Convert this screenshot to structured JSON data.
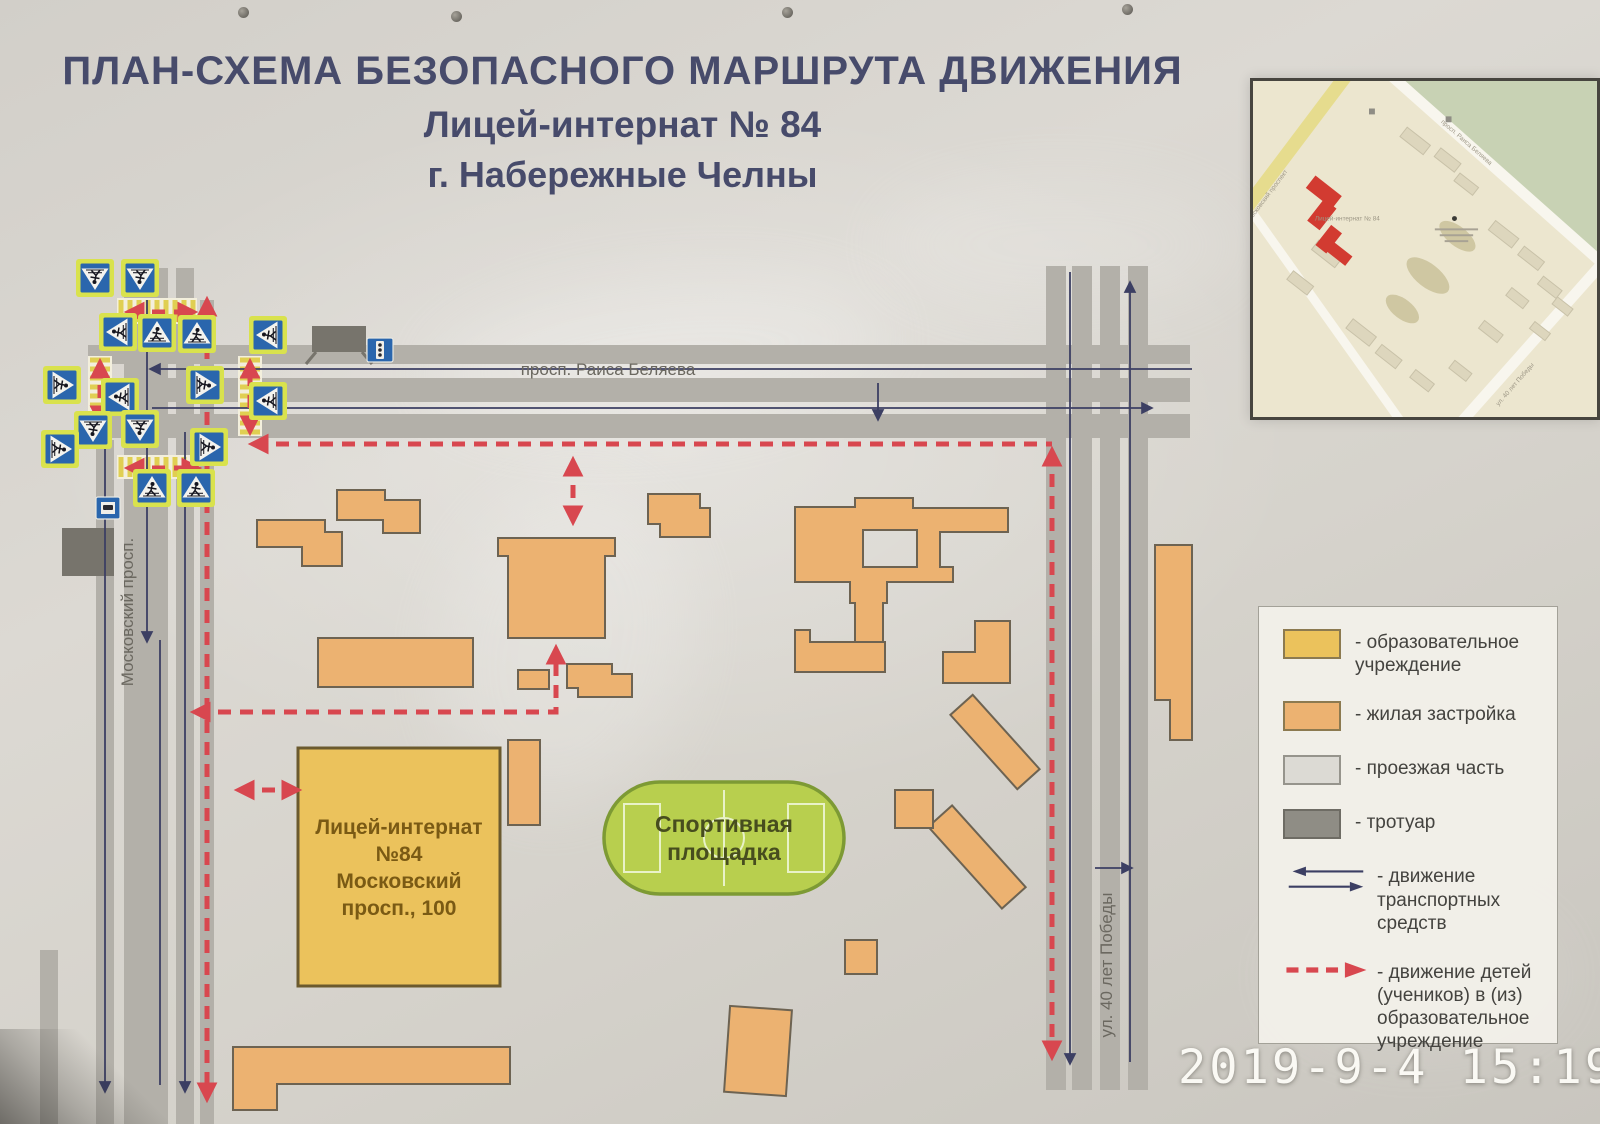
{
  "title": {
    "line1": "ПЛАН-СХЕМА БЕЗОПАСНОГО МАРШРУТА ДВИЖЕНИЯ",
    "line2": "Лицей-интернат № 84",
    "line3": "г. Набережные Челны"
  },
  "timestamp": "2019-9-4 15:19",
  "colors": {
    "title": "#474b6b",
    "road": "#b3b0a9",
    "sidewalk": "#77746c",
    "residential_fill": "#ecb271",
    "residential_stroke": "#6d6352",
    "school_fill": "#ebc25c",
    "school_stroke": "#6b5a2e",
    "school_text": "#7a5a14",
    "field_fill": "#b8cf4e",
    "field_stroke": "#7d9a34",
    "field_lines": "#e9f2c8",
    "field_text": "#474d1e",
    "route": "#d8474f",
    "traffic": "#3c3f63",
    "street_label": "#6b6860",
    "sign_blue": "#2a66ad",
    "sign_border": "#d9e24d",
    "zebra_base": "#f3efdc",
    "zebra_stripe": "#e0cf52"
  },
  "map": {
    "road_rects": [
      [
        88,
        345,
        1102,
        19
      ],
      [
        88,
        378,
        1102,
        24
      ],
      [
        88,
        414,
        1102,
        24
      ],
      [
        124,
        268,
        44,
        856
      ],
      [
        176,
        268,
        18,
        856
      ],
      [
        200,
        300,
        14,
        824
      ],
      [
        96,
        440,
        18,
        684
      ],
      [
        40,
        950,
        18,
        174
      ],
      [
        1046,
        266,
        20,
        824
      ],
      [
        1072,
        266,
        20,
        824
      ],
      [
        1100,
        266,
        20,
        824
      ],
      [
        1128,
        266,
        20,
        824
      ]
    ],
    "sidewalk_rects": [
      [
        312,
        326,
        54,
        26
      ],
      [
        62,
        528,
        52,
        48
      ]
    ],
    "zebras": [
      [
        117,
        298,
        80,
        26,
        "v"
      ],
      [
        88,
        356,
        24,
        72,
        "h"
      ],
      [
        238,
        356,
        24,
        80,
        "h"
      ],
      [
        117,
        455,
        80,
        24,
        "v"
      ]
    ],
    "buildings": [
      {
        "path": "M257,520 L325,520 L325,532 L342,532 L342,566 L302,566 L302,547 L257,547 Z"
      },
      {
        "path": "M337,490 L385,490 L385,500 L420,500 L420,533 L383,533 L383,520 L337,520 Z"
      },
      {
        "path": "M498,538 L615,538 L615,556 L605,556 L605,638 L508,638 L508,556 L498,556 Z"
      },
      {
        "rect": [
          518,
          670,
          31,
          19
        ]
      },
      {
        "rect": [
          318,
          638,
          155,
          49
        ]
      },
      {
        "path": "M567,664 L612,664 L612,674 L632,674 L632,697 L578,697 L578,688 L567,688 Z"
      },
      {
        "path": "M648,494 L700,494 L700,508 L710,508 L710,537 L660,537 L660,524 L648,524 Z"
      },
      {
        "path": "M795,507 L855,507 L855,498 L913,498 L913,508 L1008,508 L1008,532 L940,532 L940,567 L953,567 L953,582 L887,582 L887,603 L883,603 L883,642 L855,642 L855,603 L850,603 L850,582 L795,582 Z M863,530 L917,530 L917,567 L863,567 Z"
      },
      {
        "path": "M795,630 L810,630 L810,642 L885,642 L885,672 L795,672 Z"
      },
      {
        "path": "M975,621 L1010,621 L1010,683 L943,683 L943,652 L975,652 Z"
      },
      {
        "rect": [
          945,
          727,
          100,
          30
        ],
        "rot": 48
      },
      {
        "rect": [
          922,
          841,
          110,
          32
        ],
        "rot": 48
      },
      {
        "rect": [
          895,
          790,
          38,
          38
        ]
      },
      {
        "rect": [
          845,
          940,
          32,
          34
        ]
      },
      {
        "rect": [
          727,
          1008,
          62,
          86
        ],
        "rot": 4
      },
      {
        "path": "M233,1047 L510,1047 L510,1084 L277,1084 L277,1110 L233,1110 Z"
      },
      {
        "path": "M1155,545 L1192,545 L1192,740 L1170,740 L1170,700 L1155,700 Z"
      },
      {
        "rect": [
          508,
          740,
          32,
          85
        ]
      }
    ],
    "school": {
      "x": 298,
      "y": 748,
      "w": 202,
      "h": 238,
      "label_lines": [
        "Лицей-интернат",
        "№84",
        "Московский",
        "просп., 100"
      ]
    },
    "sports_field": {
      "x": 604,
      "y": 782,
      "w": 240,
      "h": 112,
      "label_lines": [
        "Спортивная",
        "площадка"
      ]
    },
    "street_labels": [
      {
        "text": "просп. Раиса Беляева",
        "x": 608,
        "y": 375,
        "rot": 0
      },
      {
        "text": "Московский просп.",
        "x": 133,
        "y": 612,
        "rot": -90
      },
      {
        "text": "ул. 40 лет Победы",
        "x": 1112,
        "y": 965,
        "rot": -90
      }
    ],
    "traffic_lines": [
      {
        "x1": 1192,
        "y1": 369,
        "x2": 152,
        "y2": 369,
        "arrow": "end"
      },
      {
        "x1": 152,
        "y1": 408,
        "x2": 1150,
        "y2": 408,
        "arrow": "end"
      },
      {
        "x1": 878,
        "y1": 383,
        "x2": 878,
        "y2": 418,
        "arrow": "end"
      },
      {
        "x1": 105,
        "y1": 432,
        "x2": 105,
        "y2": 1090,
        "arrow": "end"
      },
      {
        "x1": 147,
        "y1": 300,
        "x2": 147,
        "y2": 640,
        "arrow": "end"
      },
      {
        "x1": 185,
        "y1": 432,
        "x2": 185,
        "y2": 1090,
        "arrow": "end"
      },
      {
        "x1": 160,
        "y1": 640,
        "x2": 160,
        "y2": 1085,
        "arrow": "none"
      },
      {
        "x1": 1070,
        "y1": 272,
        "x2": 1070,
        "y2": 1062,
        "arrow": "end"
      },
      {
        "x1": 1130,
        "y1": 1062,
        "x2": 1130,
        "y2": 284,
        "arrow": "end"
      },
      {
        "x1": 1095,
        "y1": 868,
        "x2": 1130,
        "y2": 868,
        "arrow": "end"
      }
    ],
    "route_segments": [
      {
        "pts": [
          [
            207,
            302
          ],
          [
            207,
            1097
          ]
        ],
        "a_start": true,
        "a_end": true
      },
      {
        "pts": [
          [
            254,
            444
          ],
          [
            1052,
            444
          ]
        ],
        "a_start": true,
        "a_end": false
      },
      {
        "pts": [
          [
            1052,
            452
          ],
          [
            1052,
            1055
          ]
        ],
        "a_start": true,
        "a_end": true
      },
      {
        "pts": [
          [
            196,
            712
          ],
          [
            556,
            712
          ],
          [
            556,
            650
          ]
        ],
        "a_start": true,
        "a_end": true
      },
      {
        "pts": [
          [
            240,
            790
          ],
          [
            296,
            790
          ]
        ],
        "a_start": true,
        "a_end": true
      },
      {
        "pts": [
          [
            573,
            520
          ],
          [
            573,
            462
          ]
        ],
        "a_start": true,
        "a_end": true
      },
      {
        "pts": [
          [
            130,
            312
          ],
          [
            192,
            312
          ]
        ],
        "a_start": true,
        "a_end": true
      },
      {
        "pts": [
          [
            100,
            420
          ],
          [
            100,
            364
          ]
        ],
        "a_start": true,
        "a_end": true
      },
      {
        "pts": [
          [
            250,
            430
          ],
          [
            250,
            364
          ]
        ],
        "a_start": true,
        "a_end": true
      },
      {
        "pts": [
          [
            130,
            468
          ],
          [
            196,
            468
          ]
        ],
        "a_start": true,
        "a_end": true
      }
    ],
    "crossing_signs": [
      {
        "x": 95,
        "y": 278,
        "dir": "down"
      },
      {
        "x": 140,
        "y": 278,
        "dir": "down"
      },
      {
        "x": 118,
        "y": 332,
        "dir": "left"
      },
      {
        "x": 157,
        "y": 333,
        "dir": "up"
      },
      {
        "x": 197,
        "y": 334,
        "dir": "up"
      },
      {
        "x": 268,
        "y": 335,
        "dir": "left"
      },
      {
        "x": 62,
        "y": 385,
        "dir": "right"
      },
      {
        "x": 120,
        "y": 397,
        "dir": "left"
      },
      {
        "x": 205,
        "y": 385,
        "dir": "right"
      },
      {
        "x": 268,
        "y": 401,
        "dir": "left"
      },
      {
        "x": 93,
        "y": 430,
        "dir": "down"
      },
      {
        "x": 140,
        "y": 429,
        "dir": "down"
      },
      {
        "x": 60,
        "y": 449,
        "dir": "right"
      },
      {
        "x": 209,
        "y": 447,
        "dir": "right"
      },
      {
        "x": 152,
        "y": 488,
        "dir": "up"
      },
      {
        "x": 196,
        "y": 488,
        "dir": "up"
      }
    ],
    "bus_stop_sign": {
      "x": 108,
      "y": 508
    },
    "traffic_light_sign": {
      "x": 380,
      "y": 350
    }
  },
  "inset": {
    "green_poly": "155,0 350,0 350,178",
    "roads": [
      {
        "x1": 140,
        "y1": -6,
        "x2": 356,
        "y2": 186,
        "w": 11,
        "c": "#f8f6ee"
      },
      {
        "x1": 95,
        "y1": -6,
        "x2": -12,
        "y2": 136,
        "w": 14,
        "c": "#e6dc8e"
      },
      {
        "x1": 0,
        "y1": 135,
        "x2": 150,
        "y2": 346,
        "w": 9,
        "c": "#f8f6ee"
      },
      {
        "x1": 356,
        "y1": 185,
        "x2": 213,
        "y2": 346,
        "w": 11,
        "c": "#f8f6ee"
      }
    ],
    "buildings": [
      [
        150,
        55,
        30,
        12
      ],
      [
        185,
        75,
        26,
        11
      ],
      [
        205,
        100,
        24,
        10
      ],
      [
        240,
        150,
        30,
        12
      ],
      [
        270,
        175,
        26,
        11
      ],
      [
        290,
        205,
        24,
        10
      ],
      [
        258,
        216,
        22,
        10
      ],
      [
        60,
        170,
        30,
        12
      ],
      [
        35,
        200,
        26,
        11
      ],
      [
        95,
        250,
        30,
        12
      ],
      [
        125,
        275,
        26,
        11
      ],
      [
        160,
        300,
        24,
        10
      ],
      [
        200,
        290,
        22,
        10
      ],
      [
        230,
        250,
        24,
        10
      ],
      [
        282,
        250,
        20,
        9
      ],
      [
        305,
        225,
        20,
        9
      ]
    ],
    "yards": [
      [
        178,
        198,
        26,
        12
      ],
      [
        208,
        158,
        22,
        10
      ],
      [
        152,
        232,
        20,
        10
      ]
    ],
    "school_rects": [
      [
        55,
        105,
        34,
        16
      ],
      [
        62,
        122,
        16,
        28
      ],
      [
        70,
        148,
        14,
        26
      ],
      [
        76,
        170,
        24,
        12
      ]
    ],
    "labels": [
      {
        "t": "Московский проспект",
        "x": 16,
        "y": 118,
        "rot": -53
      },
      {
        "t": "просп. Раиса Беляева",
        "x": 216,
        "y": 64,
        "rot": 41
      },
      {
        "t": "ул. 40 лет Победы",
        "x": 268,
        "y": 310,
        "rot": -49
      },
      {
        "t": "Лицей-интернат № 84",
        "x": 96,
        "y": 142,
        "rot": 0
      }
    ],
    "micro_bars": [
      [
        185,
        150,
        44
      ],
      [
        190,
        156,
        34
      ],
      [
        195,
        162,
        24
      ]
    ],
    "dot": [
      205,
      140
    ],
    "icons": [
      [
        118,
        28
      ],
      [
        196,
        36
      ]
    ]
  },
  "legend": {
    "items": [
      {
        "type": "swatch",
        "fill": "#ebc25c",
        "stroke": "#8c7a50",
        "label": "- образовательное учреждение"
      },
      {
        "type": "swatch",
        "fill": "#ecb271",
        "stroke": "#8c7a50",
        "label": "- жилая застройка"
      },
      {
        "type": "swatch",
        "fill": "#dcdad4",
        "stroke": "#96948c",
        "label": "- проезжая часть"
      },
      {
        "type": "swatch",
        "fill": "#8f8d85",
        "stroke": "#6e6c64",
        "label": "- тротуар"
      },
      {
        "type": "traffic",
        "label": "- движение транспортных средств"
      },
      {
        "type": "route",
        "label": "- движение детей (учеников) в (из) образовательное учреждение"
      }
    ]
  }
}
